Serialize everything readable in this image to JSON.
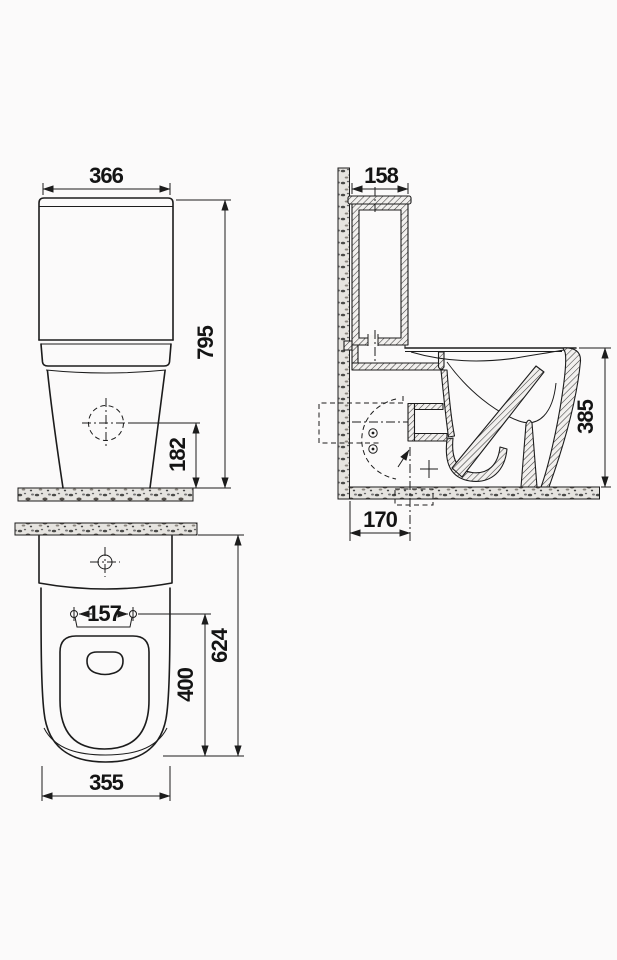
{
  "colors": {
    "ink": "#1c1c1c",
    "paper": "#fbfafa",
    "strip_fill": "#e6e4e0"
  },
  "dimensions": {
    "front_width": "366",
    "front_total_height": "795",
    "front_outlet_height": "182",
    "side_cistern_depth": "158",
    "side_bowl_height": "385",
    "side_outlet_offset": "170",
    "plan_hole_spacing": "157",
    "plan_seat_depth": "400",
    "plan_total_depth": "624",
    "plan_bowl_width": "355"
  }
}
